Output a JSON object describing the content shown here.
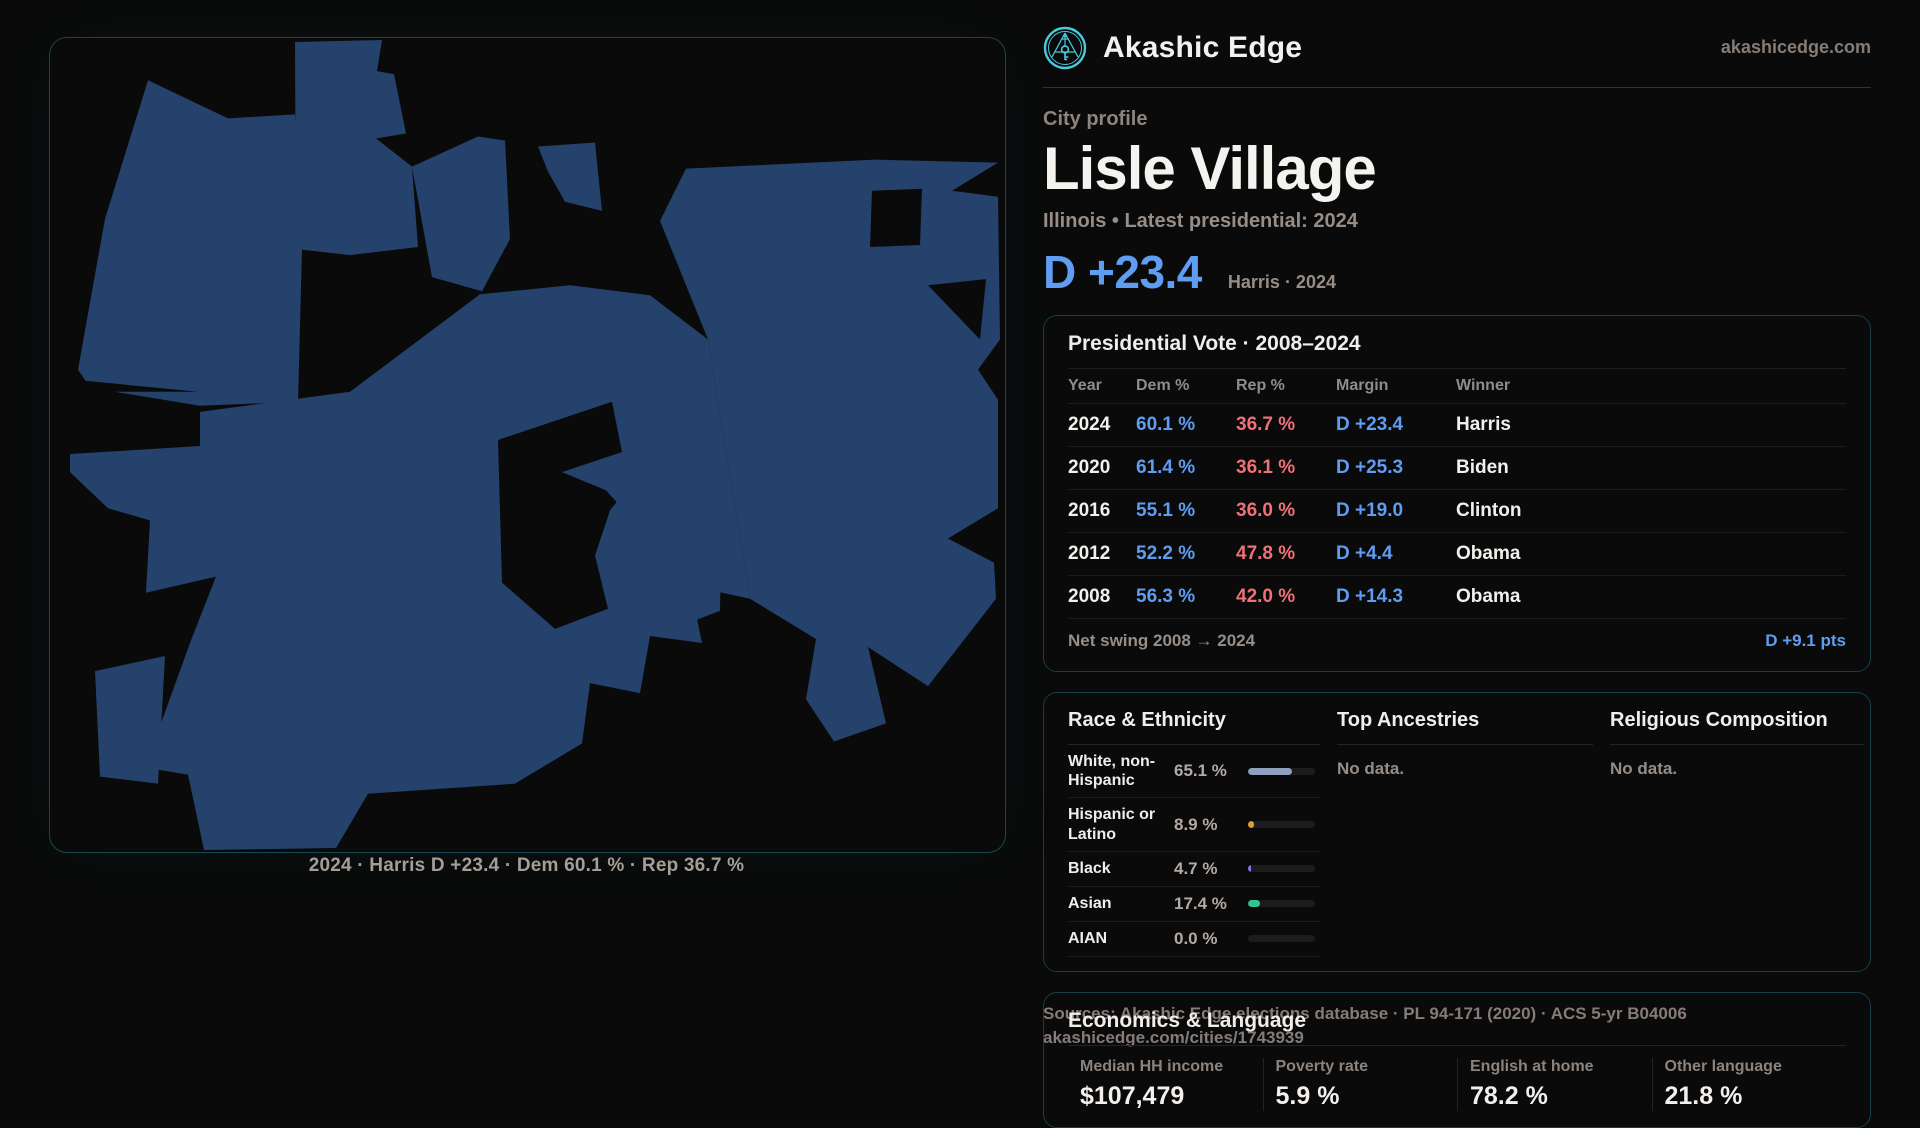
{
  "brand": {
    "name": "Akashic Edge",
    "domain": "akashicedge.com"
  },
  "page": {
    "eyebrow": "City profile",
    "title": "Lisle Village",
    "subtitle": "Illinois • Latest presidential: 2024",
    "hero_margin": "D +23.4",
    "hero_caption": "Harris · 2024"
  },
  "map": {
    "caption": "2024 · Harris D +23.4 · Dem 60.1 % · Rep 36.7 %"
  },
  "presidential": {
    "title": "Presidential Vote · 2008–2024",
    "columns": [
      "Year",
      "Dem %",
      "Rep %",
      "Margin",
      "Winner"
    ],
    "rows": [
      {
        "year": "2024",
        "dem": "60.1 %",
        "rep": "36.7 %",
        "margin": "D +23.4",
        "winner": "Harris"
      },
      {
        "year": "2020",
        "dem": "61.4 %",
        "rep": "36.1 %",
        "margin": "D +25.3",
        "winner": "Biden"
      },
      {
        "year": "2016",
        "dem": "55.1 %",
        "rep": "36.0 %",
        "margin": "D +19.0",
        "winner": "Clinton"
      },
      {
        "year": "2012",
        "dem": "52.2 %",
        "rep": "47.8 %",
        "margin": "D +4.4",
        "winner": "Obama"
      },
      {
        "year": "2008",
        "dem": "56.3 %",
        "rep": "42.0 %",
        "margin": "D +14.3",
        "winner": "Obama"
      }
    ],
    "net_swing_label": "Net swing 2008 → 2024",
    "net_swing_value": "D +9.1 pts"
  },
  "demographics": {
    "race_title": "Race & Ethnicity",
    "race_rows": [
      {
        "label": "White, non-Hispanic",
        "value": "65.1 %",
        "pct": 65.1,
        "color": "#8da0bd"
      },
      {
        "label": "Hispanic or Latino",
        "value": "8.9 %",
        "pct": 8.9,
        "color": "#e89c30"
      },
      {
        "label": "Black",
        "value": "4.7 %",
        "pct": 4.7,
        "color": "#8b72e8"
      },
      {
        "label": "Asian",
        "value": "17.4 %",
        "pct": 17.4,
        "color": "#2dc68f"
      },
      {
        "label": "AIAN",
        "value": "0.0 %",
        "pct": 0,
        "color": "#8da0bd"
      }
    ],
    "ancestries_title": "Top Ancestries",
    "ancestries_empty": "No data.",
    "religion_title": "Religious Composition",
    "religion_empty": "No data."
  },
  "economics": {
    "title": "Economics & Language",
    "stats": [
      {
        "label": "Median HH income",
        "value": "$107,479"
      },
      {
        "label": "Poverty rate",
        "value": "5.9 %"
      },
      {
        "label": "English at home",
        "value": "78.2 %"
      },
      {
        "label": "Other language",
        "value": "21.8 %"
      }
    ]
  },
  "footer": {
    "sources": "Sources: Akashic Edge elections database · PL 94-171 (2020) · ACS 5-yr B04006",
    "permalink": "akashicedge.com/cities/1743939"
  },
  "colors": {
    "dem": "#5f9df2",
    "rep": "#ef7078",
    "accent_teal": "#49c9db",
    "map_fill": "#24426b"
  }
}
